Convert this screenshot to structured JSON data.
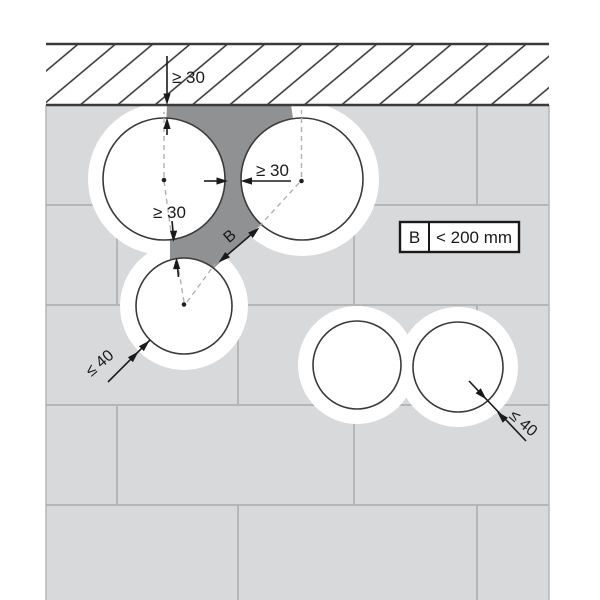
{
  "figure": {
    "kind": "installation-diagram",
    "elements": {
      "slab_hatch": "diagonal-hatched band (ceiling slab) along the top",
      "wall": "light grey masonry wall with running-bond joints",
      "pipes": "five circular pipe cross-sections with white annular gaps",
      "infill": "dark grey mortar infill between the three upper-left pipes and the slab"
    }
  },
  "annotations": {
    "dim_slab_gap": "≥ 30",
    "dim_pipe_gap_horizontal": "≥ 30",
    "dim_pipe_gap_vertical": "≥ 30",
    "infill_label": "B",
    "annular_gap_left": "≤ 40",
    "annular_gap_right": "≤ 40"
  },
  "legend": {
    "key": "B",
    "value": "< 200 mm"
  },
  "colors": {
    "background": "#ffffff",
    "wall": "#d8d9da",
    "wall_joints": "#b4b6b8",
    "slab_hatch_lines": "#2f2f2f",
    "infill": "#8f9193",
    "pipe_fill": "#ffffff",
    "outline": "#3a3a3a",
    "dimension": "#1a1a1a",
    "dashed_guides": "#b0b0b3"
  }
}
